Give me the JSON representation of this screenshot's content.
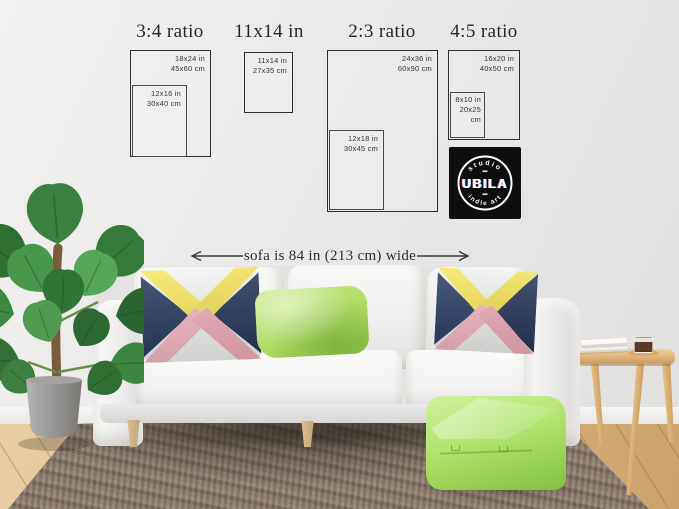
{
  "size_guide": {
    "sections": [
      {
        "label": "3:4 ratio"
      },
      {
        "label": "11x14 in"
      },
      {
        "label": "2:3 ratio"
      },
      {
        "label": "4:5 ratio"
      }
    ],
    "frames": {
      "f18x24": {
        "inches": "18x24 in",
        "cm": "45x60 cm"
      },
      "f12x16": {
        "inches": "12x16 in",
        "cm": "30x40 cm"
      },
      "f11x14": {
        "inches": "11x14 in",
        "cm": "27x35 cm"
      },
      "f24x36": {
        "inches": "24x36 in",
        "cm": "60x90 cm"
      },
      "f12x18": {
        "inches": "12x18 in",
        "cm": "30x45 cm"
      },
      "f16x20": {
        "inches": "16x20 in",
        "cm": "40x50 cm"
      },
      "f8x10": {
        "inches": "8x10 in",
        "cm": "20x25 cm"
      }
    }
  },
  "brand": {
    "arc_top": "studio",
    "name": "UBILA",
    "arc_bottom": "indie art"
  },
  "annotation": {
    "sofa_width": "sofa is 84 in (213 cm) wide"
  },
  "colors": {
    "wall": "#eae9e7",
    "frame_outline": "#2e2e2e",
    "text_dark": "#2b2b2e",
    "logo_bg": "#0e0e0e",
    "logo_text": "#ffffff",
    "sofa": "#f2f1ef",
    "rug": "#827364",
    "floor_wood": "#ddbb85",
    "plant_green": "#3a8140",
    "pot_gray": "#9b9a98",
    "pouf_green": "#a8dd64",
    "pillow_navy": "#223459",
    "pillow_yellow": "#f6e558",
    "pillow_pink": "#f3b6c2",
    "pillow_green": "#b7e070",
    "table_wood": "#e0b87c"
  }
}
